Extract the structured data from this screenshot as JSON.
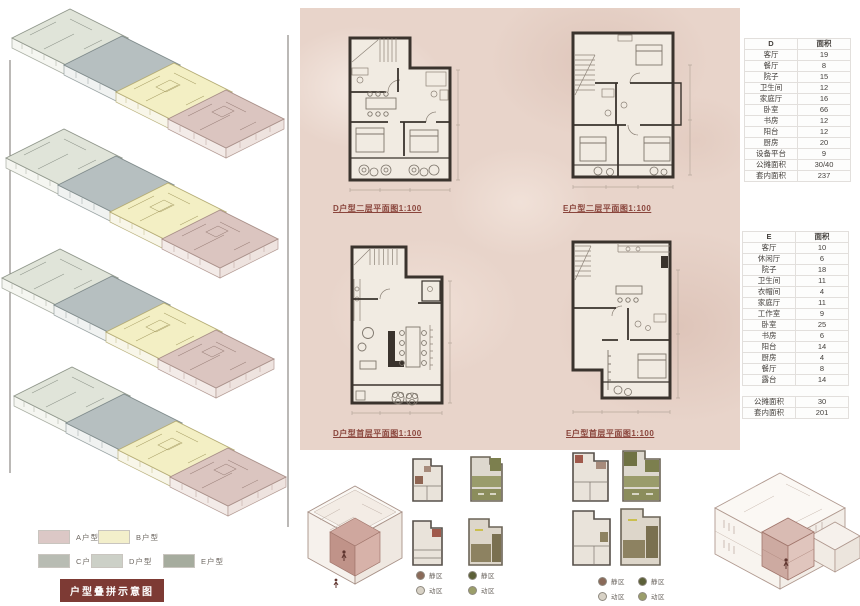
{
  "plans": {
    "d_upper_label": "D户型二层平面图1:100",
    "e_upper_label": "E户型二层平面图1:100",
    "d_ground_label": "D户型首层平面图1:100",
    "e_ground_label": "E户型首层平面图1:100"
  },
  "tables": {
    "d": {
      "name": "D",
      "area_header": "面积",
      "rows": [
        [
          "客厅",
          "19"
        ],
        [
          "餐厅",
          "8"
        ],
        [
          "院子",
          "15"
        ],
        [
          "卫生间",
          "12"
        ],
        [
          "家庭厅",
          "16"
        ],
        [
          "卧室",
          "66"
        ],
        [
          "书房",
          "12"
        ],
        [
          "阳台",
          "12"
        ],
        [
          "厨房",
          "20"
        ],
        [
          "设备平台",
          "9"
        ],
        [
          "公摊面积",
          "30/40"
        ],
        [
          "套内面积",
          "237"
        ]
      ]
    },
    "e": {
      "name": "E",
      "area_header": "面积",
      "rows": [
        [
          "客厅",
          "10"
        ],
        [
          "休闲厅",
          "6"
        ],
        [
          "院子",
          "18"
        ],
        [
          "卫生间",
          "11"
        ],
        [
          "衣帽间",
          "4"
        ],
        [
          "家庭厅",
          "11"
        ],
        [
          "工作室",
          "9"
        ],
        [
          "卧室",
          "25"
        ],
        [
          "书房",
          "6"
        ],
        [
          "阳台",
          "14"
        ],
        [
          "厨房",
          "4"
        ],
        [
          "餐厅",
          "8"
        ],
        [
          "露台",
          "14"
        ],
        [
          "",
          ""
        ],
        [
          "公摊面积",
          "30"
        ],
        [
          "套内面积",
          "201"
        ]
      ]
    }
  },
  "overlay_legend": {
    "items": [
      {
        "label": "A户型",
        "color": "#dcc8c6"
      },
      {
        "label": "B户型",
        "color": "#f3efcb"
      },
      {
        "label": "C户型",
        "color": "#b8bcb3"
      },
      {
        "label": "D户型",
        "color": "#ccd0c7"
      },
      {
        "label": "E户型",
        "color": "#a6ac9e"
      }
    ],
    "badge": {
      "label": "户型叠拼示意图",
      "bg": "#7d3a34",
      "fg": "#ffffff"
    }
  },
  "zone_legends": {
    "group1": [
      {
        "label": "静区",
        "dot": "#8a6a59"
      },
      {
        "label": "动区",
        "dot": "#d8d2c6"
      }
    ],
    "group2": [
      {
        "label": "静区",
        "dot": "#5c6038"
      },
      {
        "label": "动区",
        "dot": "#9b9e6a"
      }
    ],
    "group3": [
      {
        "label": "静区",
        "dot": "#8a6a59"
      },
      {
        "label": "动区",
        "dot": "#d8d2c6"
      }
    ],
    "group4": [
      {
        "label": "静区",
        "dot": "#5c6038"
      },
      {
        "label": "动区",
        "dot": "#9b9e6a"
      }
    ]
  },
  "colors": {
    "panel_bg": "#e8d4ca",
    "wall": "#3a332d",
    "label_red": "#8a453c",
    "badge_red": "#7d3a34"
  }
}
